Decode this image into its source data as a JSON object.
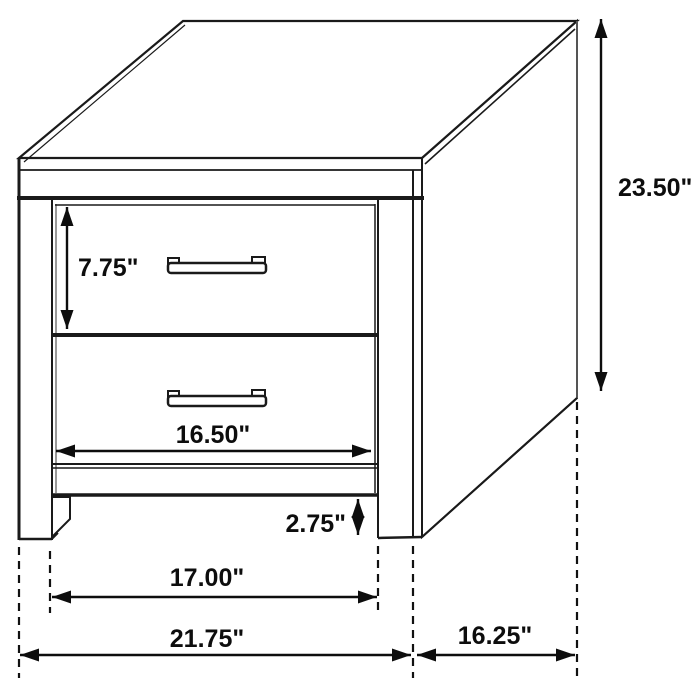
{
  "diagram": {
    "type": "furniture-dimension-line-drawing",
    "subject": "two-drawer-nightstand",
    "colors": {
      "line": "#1a1a1a",
      "background": "#ffffff",
      "shade": "#8a8a8a",
      "rear_edge": "#555555"
    },
    "dimensions": {
      "overall_height": "23.50\"",
      "drawer_height": "7.75\"",
      "drawer_width": "16.50\"",
      "leg_height": "2.75\"",
      "between_legs_width": "17.00\"",
      "overall_width": "21.75\"",
      "depth": "16.25\""
    }
  }
}
